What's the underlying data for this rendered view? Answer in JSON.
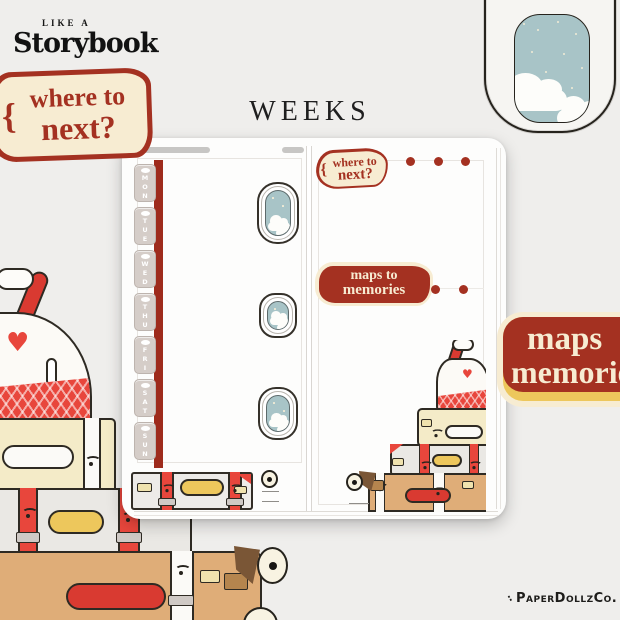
{
  "brand": {
    "tagline": "LIKE A",
    "name": "Storybook"
  },
  "page_title": "WEEKS",
  "stickers": {
    "where_to_next_large": {
      "brace": "{",
      "line1": "where to",
      "line2": "next?"
    },
    "where_to_next_small": {
      "brace": "{",
      "line1": "where to",
      "line2": "next?"
    },
    "maps_to_memories_small": {
      "line1": "maps to",
      "line2": "memories"
    },
    "maps_to_memories_large": {
      "line1": "maps",
      "line2": "memories"
    }
  },
  "planner": {
    "day_tabs": [
      "MON",
      "TUE",
      "WED",
      "THU",
      "FRI",
      "SAT",
      "SUN"
    ],
    "dot_rows": [
      3,
      2
    ]
  },
  "watermark": "PaperDollzCo.",
  "colors": {
    "background": "#efeeec",
    "accent_red": "#a43121",
    "bright_red": "#e8463c",
    "tab_red": "#9e2b1c",
    "cream": "#f7ecd2",
    "yellow": "#edc75c",
    "sky_blue": "#a8c4c7",
    "suitcase_tan": "#dfad78",
    "suitcase_cream": "#f4ebc8",
    "suitcase_gray": "#eae8e4",
    "tab_mauve": "#d5cdc8"
  }
}
